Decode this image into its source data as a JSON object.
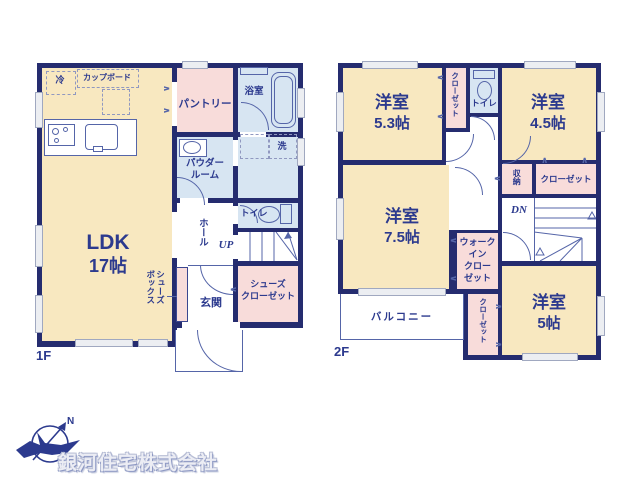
{
  "floor1": {
    "label": "1F",
    "ldk": {
      "name": "LDK",
      "size": "17帖"
    },
    "kitchen": {
      "fridge": "冷",
      "cupboard": "カップボード"
    },
    "pantry": "パントリー",
    "bathroom": "浴室",
    "laundry": "洗",
    "powder_room": "パウダー\nルーム",
    "toilet": "トイレ",
    "hall": "ホール",
    "stairs_up": "UP",
    "shoe_box": "シューズ\nボックス",
    "entrance": "玄関",
    "shoe_closet": "シューズ\nクローゼット"
  },
  "floor2": {
    "label": "2F",
    "room_53": {
      "name": "洋室",
      "size": "5.3帖"
    },
    "closet_top": "クローゼット",
    "toilet": "トイレ",
    "room_45": {
      "name": "洋室",
      "size": "4.5帖"
    },
    "storage": "収納",
    "closet_mid": "クローゼット",
    "stairs_down": "DN",
    "room_75": {
      "name": "洋室",
      "size": "7.5帖"
    },
    "walk_in_closet": "ウォーク\nイン\nクロー\nゼット",
    "balcony": "バルコニー",
    "closet_bottom": "クローゼット",
    "room_5": {
      "name": "洋室",
      "size": "5帖"
    }
  },
  "footer": {
    "company": "銀河住宅株式会社",
    "north": "N"
  }
}
